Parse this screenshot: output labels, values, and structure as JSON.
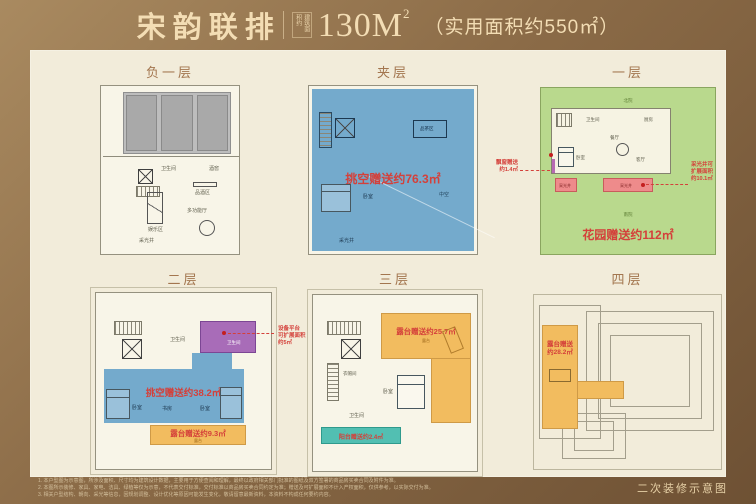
{
  "colors": {
    "frame_brown_light": "#a98a60",
    "frame_brown_dark": "#6e5134",
    "panel_cream": "#f2ecda",
    "title_cream": "#f3ddb4",
    "floor_label_brown": "#a3764f",
    "blue_fill": "#74aacc",
    "green_fill": "#b9d98d",
    "orange_fill": "#f2bc5f",
    "purple_fill": "#a86cb8",
    "teal_fill": "#52bfb2",
    "pink_fill": "#ee8b8b",
    "gray_parking": "#bdbdbd",
    "red_annotation": "#d4403a"
  },
  "header": {
    "title": "宋韵联排",
    "area_note": "建筑面积约",
    "area_value": "130M",
    "area_sup": "2",
    "subtitle": "（实用面积约550㎡）"
  },
  "floors": [
    {
      "id": "b1",
      "label": "负一层",
      "rooms": {
        "bath": "卫生间",
        "wine": "酒窖",
        "tasting": "品酒区",
        "fun": "娱乐区",
        "hall": "多功能厅",
        "lightwell": "采光井"
      }
    },
    {
      "id": "mezz",
      "label": "夹层",
      "gift": "挑空赠送约76.3㎡",
      "rooms": {
        "tea": "品茶区",
        "bed": "卧室",
        "void": "中空",
        "lightwell": "采光井"
      }
    },
    {
      "id": "f1",
      "label": "一层",
      "gift": "花园赠送约112㎡",
      "annotation_left": [
        "飘窗赠送",
        "约1.4㎡"
      ],
      "annotation_right": [
        "采光井可",
        "扩展面积",
        "约10.1㎡"
      ],
      "rooms": {
        "bath": "卫生间",
        "kitchen": "厨房",
        "dining": "餐厅",
        "living": "客厅",
        "bed": "卧室",
        "north_yard": "北院",
        "south_yard": "南院",
        "lightwell1": "采光井",
        "lightwell2": "采光井"
      }
    },
    {
      "id": "f2",
      "label": "二层",
      "gift_void": "挑空赠送约38.2㎡",
      "gift_terrace": "露台赠送约9.3㎡",
      "annotation_right": [
        "设备平台",
        "可扩展面积",
        "约5㎡"
      ],
      "rooms": {
        "bath1": "卫生间",
        "bath2": "卫生间",
        "bed1": "卧室",
        "study": "书房",
        "bed2": "卧室",
        "terrace": "露台"
      }
    },
    {
      "id": "f3",
      "label": "三层",
      "gift_terrace": "露台赠送约25.7㎡",
      "gift_balcony": "阳台赠送约2.4㎡",
      "rooms": {
        "closet": "衣帽间",
        "bath": "卫生间",
        "bed": "卧室",
        "terrace": "露台"
      }
    },
    {
      "id": "f4",
      "label": "四层",
      "gift": [
        "露台赠送",
        "约28.2㎡"
      ]
    }
  ],
  "footer": {
    "disclaimers": [
      "1. 本户型图为示意图，所涉及面积、尺寸均为建筑设计数据，主要用于方便查阅和理解，最终以政府相关部门批准的图纸及双方签署的商品房买卖合同及附件为准。",
      "2. 本图所示装修、家具、家电、洁具、绿植等仅为示意，不代表交付标准，交付标准以商品房买卖合同约定为准；赠送及可扩展面积不计入产权面积，仅供参考，以实际交付为准。",
      "3. 相关户型结构、朝向、采光等信息，因规划调整、设计优化等原因可能发生变化，敬请留意最新资料，本资料不构成任何要约内容。"
    ],
    "note": "二次装修示意图"
  }
}
